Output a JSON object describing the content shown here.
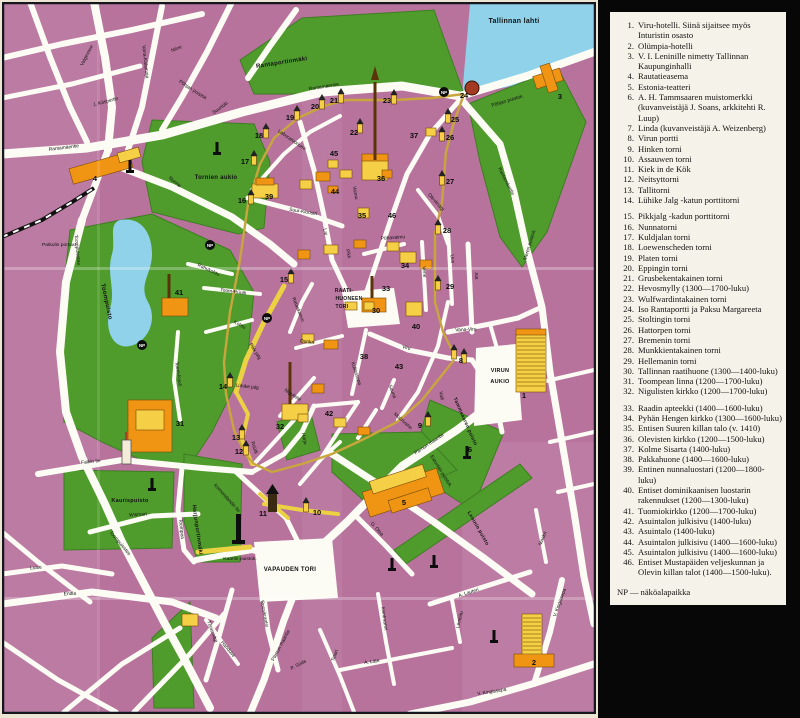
{
  "colors": {
    "block_pink": "#b8739d",
    "block_pink_dark": "#aa6590",
    "park_green": "#4f9c2d",
    "park_green_dark": "#3e7d22",
    "water_blue": "#8fd2ea",
    "road_white": "#fcfcf5",
    "road_yellow": "#ecd243",
    "wall_yellow": "#c9a63d",
    "building_yellow": "#f5cf46",
    "building_orange": "#ef9413",
    "legend_paper": "#f5f2ea",
    "legend_ink": "#141210",
    "frame_dark": "#16161e",
    "rail_black": "#111111"
  },
  "legend": {
    "np_note": "NP — näköalapaikka",
    "items": [
      {
        "num": "1.",
        "text": "Viru-hotelli. Siinä sijaitsee myös Inturistin osasto"
      },
      {
        "num": "2.",
        "text": "Olümpia-hotelli"
      },
      {
        "num": "3.",
        "text": "V. I. Leninille nimetty Tallinnan Kaupunginhalli"
      },
      {
        "num": "4.",
        "text": "Rautatieasema"
      },
      {
        "num": "5.",
        "text": "Estonia-teatteri"
      },
      {
        "num": "6.",
        "text": "A. H. Tammsaaren muistomerkki (kuvanveistäjä J. Soans, arkkitehti R. Luup)"
      },
      {
        "num": "7.",
        "text": "Linda (kuvanveistäjä A. Weizenberg)"
      },
      {
        "num": "8.",
        "text": "Virun portti"
      },
      {
        "num": "9.",
        "text": "Hinken torni"
      },
      {
        "num": "10.",
        "text": "Assauwen torni"
      },
      {
        "num": "11.",
        "text": "Kiek in de Kök"
      },
      {
        "num": "12.",
        "text": "Neitsyttorni"
      },
      {
        "num": "13.",
        "text": "Tallitorni"
      },
      {
        "num": "14.",
        "text": "Lühike Jalg -katun porttitorni",
        "gap": true
      },
      {
        "num": "15.",
        "text": "Pikkjalg -kadun porttitorni"
      },
      {
        "num": "16.",
        "text": "Nunnatorni"
      },
      {
        "num": "17.",
        "text": "Kuldjalan torni"
      },
      {
        "num": "18.",
        "text": "Loewenscheden torni"
      },
      {
        "num": "19.",
        "text": "Platen torni"
      },
      {
        "num": "20.",
        "text": "Eppingin torni"
      },
      {
        "num": "21.",
        "text": "Grusbekentakainen torni"
      },
      {
        "num": "22.",
        "text": "Hevosmylly (1300—1700-luku)"
      },
      {
        "num": "23.",
        "text": "Wulfwardintakainen torni"
      },
      {
        "num": "24.",
        "text": "Iso Rantaportti ja Paksu Margareeta"
      },
      {
        "num": "25.",
        "text": "Stoltingin torni"
      },
      {
        "num": "26.",
        "text": "Hattorpen torni"
      },
      {
        "num": "27.",
        "text": "Bremenin torni"
      },
      {
        "num": "28.",
        "text": "Munkkientakainen torni"
      },
      {
        "num": "29.",
        "text": "Hellemanin torni"
      },
      {
        "num": "30.",
        "text": "Tallinnan raatihuone (1300—1400-luku)"
      },
      {
        "num": "31.",
        "text": "Toompean linna (1200—1700-luku)"
      },
      {
        "num": "32.",
        "text": "Nigulisten kirkko (1200—1700-luku)",
        "gap": true
      },
      {
        "num": "33.",
        "text": "Raadin apteekki (1400—1600-luku)"
      },
      {
        "num": "34.",
        "text": "Pyhän Hengen kirkko (1300—1600-luku)"
      },
      {
        "num": "35.",
        "text": "Entisen Suuren killan talo (v. 1410)"
      },
      {
        "num": "36.",
        "text": "Olevisten kirkko (1200—1500-luku)"
      },
      {
        "num": "37.",
        "text": "Kolme Sisarta (1400-luku)"
      },
      {
        "num": "38.",
        "text": "Pakkahuone (1400—1600-luku)"
      },
      {
        "num": "39.",
        "text": "Entinen nunnaluostari (1200—1800-luku)"
      },
      {
        "num": "40.",
        "text": "Entiset dominikaanisen luostarin rakennukset (1200—1300-luku)"
      },
      {
        "num": "41.",
        "text": "Tuomiokirkko (1200—1700-luku)"
      },
      {
        "num": "42.",
        "text": "Asuintalon julkisivu (1400-luku)"
      },
      {
        "num": "43.",
        "text": "Asuintalo (1400-luku)"
      },
      {
        "num": "44.",
        "text": "Asuintalon julkisivu (1400—1600-luku)"
      },
      {
        "num": "45.",
        "text": "Asuintalon julkisivu (1400—1600-luku)"
      },
      {
        "num": "46.",
        "text": "Entiset Mustapäiden veljeskunnan ja Olevin killan talot (1400—1500-luku)."
      }
    ]
  },
  "map": {
    "area_labels": [
      {
        "t": "Tallinnan lahti",
        "x": 512,
        "y": 21,
        "r": 0,
        "s": 7
      },
      {
        "t": "Rantaportinmäki",
        "x": 280,
        "y": 62,
        "r": -9,
        "s": 6
      },
      {
        "t": "Tornien aukio",
        "x": 214,
        "y": 177,
        "r": 0,
        "s": 6
      },
      {
        "t": "Toompuisto",
        "x": 103,
        "y": 300,
        "r": 78,
        "s": 6
      },
      {
        "t": "Kaurispuisto",
        "x": 128,
        "y": 500,
        "r": 0,
        "s": 5.5
      },
      {
        "t": "Harjunportinmäki",
        "x": 194,
        "y": 528,
        "r": 82,
        "s": 5.5
      },
      {
        "t": "Tammsaaren puisto",
        "x": 462,
        "y": 420,
        "r": 66,
        "s": 5
      },
      {
        "t": "Leninin puisto",
        "x": 475,
        "y": 527,
        "r": 60,
        "s": 5
      },
      {
        "t": "VAPAUDEN TORI",
        "x": 288,
        "y": 569,
        "r": 0,
        "s": 6
      },
      {
        "t": "VIRUN",
        "x": 498,
        "y": 370,
        "r": 0,
        "s": 5.5
      },
      {
        "t": "AUKIO",
        "x": 498,
        "y": 381,
        "r": 0,
        "s": 5.5
      },
      {
        "t": "RAATI-",
        "x": 342,
        "y": 290,
        "r": 0,
        "s": 5
      },
      {
        "t": "HUONEEN",
        "x": 347,
        "y": 298,
        "r": 0,
        "s": 5
      },
      {
        "t": "TORI",
        "x": 340,
        "y": 306,
        "r": 0,
        "s": 5
      }
    ],
    "street_labels": [
      {
        "t": "Põhjan puistok.",
        "x": 506,
        "y": 100,
        "r": -17
      },
      {
        "t": "Põhjan puistok",
        "x": 190,
        "y": 89,
        "r": 33
      },
      {
        "t": "Rantamäentie",
        "x": 62,
        "y": 147,
        "r": -7
      },
      {
        "t": "Rantamäentie",
        "x": 322,
        "y": 86,
        "r": -9
      },
      {
        "t": "Rantamäentie",
        "x": 503,
        "y": 180,
        "r": 63
      },
      {
        "t": "Meren puistok.",
        "x": 529,
        "y": 243,
        "r": -73
      },
      {
        "t": "Niine",
        "x": 175,
        "y": 48,
        "r": -22
      },
      {
        "t": "Vana-Kalamaja",
        "x": 142,
        "y": 60,
        "r": 84
      },
      {
        "t": "Valgevase",
        "x": 86,
        "y": 54,
        "r": -63
      },
      {
        "t": "J. Käspertin",
        "x": 104,
        "y": 101,
        "r": -15
      },
      {
        "t": "Suurtüki",
        "x": 219,
        "y": 107,
        "r": -36
      },
      {
        "t": "Nunne",
        "x": 172,
        "y": 181,
        "r": 40
      },
      {
        "t": "Toompuiestee",
        "x": 74,
        "y": 248,
        "r": 85
      },
      {
        "t": "Laboratooriumi",
        "x": 289,
        "y": 139,
        "r": 35
      },
      {
        "t": "Suur-Kloostri",
        "x": 301,
        "y": 211,
        "r": 9
      },
      {
        "t": "Patkulin portaat",
        "x": 57,
        "y": 244,
        "r": 0
      },
      {
        "t": "Lai",
        "x": 322,
        "y": 230,
        "r": 80
      },
      {
        "t": "Pikk",
        "x": 345,
        "y": 252,
        "r": 78
      },
      {
        "t": "Vaimu",
        "x": 352,
        "y": 191,
        "r": 80
      },
      {
        "t": "Vene",
        "x": 421,
        "y": 270,
        "r": 84
      },
      {
        "t": "Uus",
        "x": 449,
        "y": 257,
        "r": 84
      },
      {
        "t": "Aia",
        "x": 473,
        "y": 274,
        "r": 84
      },
      {
        "t": "Olevimägi",
        "x": 433,
        "y": 201,
        "r": 48
      },
      {
        "t": "Pühavaimu",
        "x": 391,
        "y": 237,
        "r": -4
      },
      {
        "t": "Vana-Viru",
        "x": 464,
        "y": 329,
        "r": -3
      },
      {
        "t": "Viru",
        "x": 404,
        "y": 347,
        "r": 14
      },
      {
        "t": "Valli",
        "x": 438,
        "y": 394,
        "r": 80
      },
      {
        "t": "Müürivahe",
        "x": 400,
        "y": 420,
        "r": 42
      },
      {
        "t": "Sauna",
        "x": 389,
        "y": 390,
        "r": 68
      },
      {
        "t": "Kullassepa",
        "x": 353,
        "y": 372,
        "r": 72
      },
      {
        "t": "Niguliste",
        "x": 290,
        "y": 394,
        "r": 33
      },
      {
        "t": "Harju",
        "x": 301,
        "y": 437,
        "r": 78
      },
      {
        "t": "Rüütli",
        "x": 251,
        "y": 446,
        "r": 72
      },
      {
        "t": "Dunkri",
        "x": 305,
        "y": 341,
        "r": 6
      },
      {
        "t": "Rataskaevu",
        "x": 295,
        "y": 308,
        "r": 68
      },
      {
        "t": "Pikk jalg",
        "x": 252,
        "y": 350,
        "r": 58
      },
      {
        "t": "Lühike jalg",
        "x": 245,
        "y": 386,
        "r": 6
      },
      {
        "t": "Kohtu",
        "x": 237,
        "y": 324,
        "r": 28
      },
      {
        "t": "Toom-Rüütli",
        "x": 231,
        "y": 291,
        "r": 8
      },
      {
        "t": "Rahukohtu",
        "x": 206,
        "y": 269,
        "r": 25
      },
      {
        "t": "Toom-Kooli",
        "x": 175,
        "y": 372,
        "r": 82
      },
      {
        "t": "Falkin tie",
        "x": 89,
        "y": 461,
        "r": -6
      },
      {
        "t": "Toompea",
        "x": 178,
        "y": 527,
        "r": 84
      },
      {
        "t": "Komendandin tie",
        "x": 224,
        "y": 497,
        "r": 48
      },
      {
        "t": "Wismari",
        "x": 136,
        "y": 514,
        "r": -4
      },
      {
        "t": "Luise",
        "x": 34,
        "y": 567,
        "r": -4
      },
      {
        "t": "Endla",
        "x": 68,
        "y": 593,
        "r": -3
      },
      {
        "t": "Toompuiestee",
        "x": 117,
        "y": 542,
        "r": 50
      },
      {
        "t": "Kaarlin puistok.",
        "x": 238,
        "y": 558,
        "r": 0
      },
      {
        "t": "Roosikrantsi",
        "x": 261,
        "y": 612,
        "r": 80
      },
      {
        "t": "Tõnismägi",
        "x": 209,
        "y": 630,
        "r": 70
      },
      {
        "t": "Hariduse",
        "x": 225,
        "y": 648,
        "r": 50
      },
      {
        "t": "Pärnun maantie",
        "x": 428,
        "y": 443,
        "r": -34
      },
      {
        "t": "Pärnun maantie",
        "x": 280,
        "y": 644,
        "r": -62
      },
      {
        "t": "P. Süda",
        "x": 297,
        "y": 664,
        "r": -28
      },
      {
        "t": "Tatari",
        "x": 334,
        "y": 654,
        "r": -70
      },
      {
        "t": "A. Läte",
        "x": 370,
        "y": 661,
        "r": -8
      },
      {
        "t": "G. Otsa",
        "x": 374,
        "y": 528,
        "r": 48
      },
      {
        "t": "Estonian puistok.",
        "x": 438,
        "y": 470,
        "r": 58
      },
      {
        "t": "A. Lauteri",
        "x": 467,
        "y": 592,
        "r": -18
      },
      {
        "t": "Lembitu",
        "x": 459,
        "y": 618,
        "r": -76
      },
      {
        "t": "Kentmanni",
        "x": 381,
        "y": 617,
        "r": 82
      },
      {
        "t": "Maakri",
        "x": 542,
        "y": 537,
        "r": -68
      },
      {
        "t": "V. Kingissepa",
        "x": 490,
        "y": 691,
        "r": -9
      },
      {
        "t": "V. Kingissepa",
        "x": 559,
        "y": 601,
        "r": -70
      }
    ],
    "markers": [
      {
        "n": "1",
        "x": 522,
        "y": 396
      },
      {
        "n": "2",
        "x": 532,
        "y": 663
      },
      {
        "n": "3",
        "x": 558,
        "y": 97
      },
      {
        "n": "4",
        "x": 93,
        "y": 179
      },
      {
        "n": "5",
        "x": 402,
        "y": 503
      },
      {
        "n": "6",
        "x": 468,
        "y": 450
      },
      {
        "n": "7",
        "x": 150,
        "y": 485
      },
      {
        "n": "8",
        "x": 459,
        "y": 361
      },
      {
        "n": "9",
        "x": 418,
        "y": 426
      },
      {
        "n": "10",
        "x": 315,
        "y": 513
      },
      {
        "n": "11",
        "x": 261,
        "y": 514
      },
      {
        "n": "12",
        "x": 237,
        "y": 452
      },
      {
        "n": "13",
        "x": 234,
        "y": 438
      },
      {
        "n": "14",
        "x": 221,
        "y": 387
      },
      {
        "n": "15",
        "x": 282,
        "y": 280
      },
      {
        "n": "16",
        "x": 240,
        "y": 201
      },
      {
        "n": "17",
        "x": 243,
        "y": 162
      },
      {
        "n": "18",
        "x": 257,
        "y": 136
      },
      {
        "n": "19",
        "x": 288,
        "y": 118
      },
      {
        "n": "20",
        "x": 313,
        "y": 107
      },
      {
        "n": "21",
        "x": 332,
        "y": 101
      },
      {
        "n": "22",
        "x": 352,
        "y": 133
      },
      {
        "n": "23",
        "x": 385,
        "y": 101
      },
      {
        "n": "24",
        "x": 462,
        "y": 96
      },
      {
        "n": "25",
        "x": 453,
        "y": 120
      },
      {
        "n": "26",
        "x": 448,
        "y": 138
      },
      {
        "n": "27",
        "x": 448,
        "y": 182
      },
      {
        "n": "28",
        "x": 445,
        "y": 231
      },
      {
        "n": "29",
        "x": 448,
        "y": 287
      },
      {
        "n": "30",
        "x": 374,
        "y": 311
      },
      {
        "n": "31",
        "x": 178,
        "y": 424
      },
      {
        "n": "32",
        "x": 278,
        "y": 427
      },
      {
        "n": "33",
        "x": 384,
        "y": 289
      },
      {
        "n": "34",
        "x": 403,
        "y": 266
      },
      {
        "n": "35",
        "x": 360,
        "y": 216
      },
      {
        "n": "36",
        "x": 379,
        "y": 179
      },
      {
        "n": "37",
        "x": 412,
        "y": 136
      },
      {
        "n": "38",
        "x": 362,
        "y": 357
      },
      {
        "n": "39",
        "x": 267,
        "y": 197
      },
      {
        "n": "40",
        "x": 414,
        "y": 327
      },
      {
        "n": "41",
        "x": 177,
        "y": 293
      },
      {
        "n": "42",
        "x": 327,
        "y": 414
      },
      {
        "n": "43",
        "x": 397,
        "y": 367
      },
      {
        "n": "44",
        "x": 333,
        "y": 192
      },
      {
        "n": "45",
        "x": 332,
        "y": 154
      },
      {
        "n": "46",
        "x": 390,
        "y": 216
      }
    ],
    "np_symbol_text": "NP",
    "np_positions": [
      {
        "x": 208,
        "y": 243
      },
      {
        "x": 140,
        "y": 343
      },
      {
        "x": 265,
        "y": 316
      },
      {
        "x": 442,
        "y": 90
      }
    ]
  }
}
